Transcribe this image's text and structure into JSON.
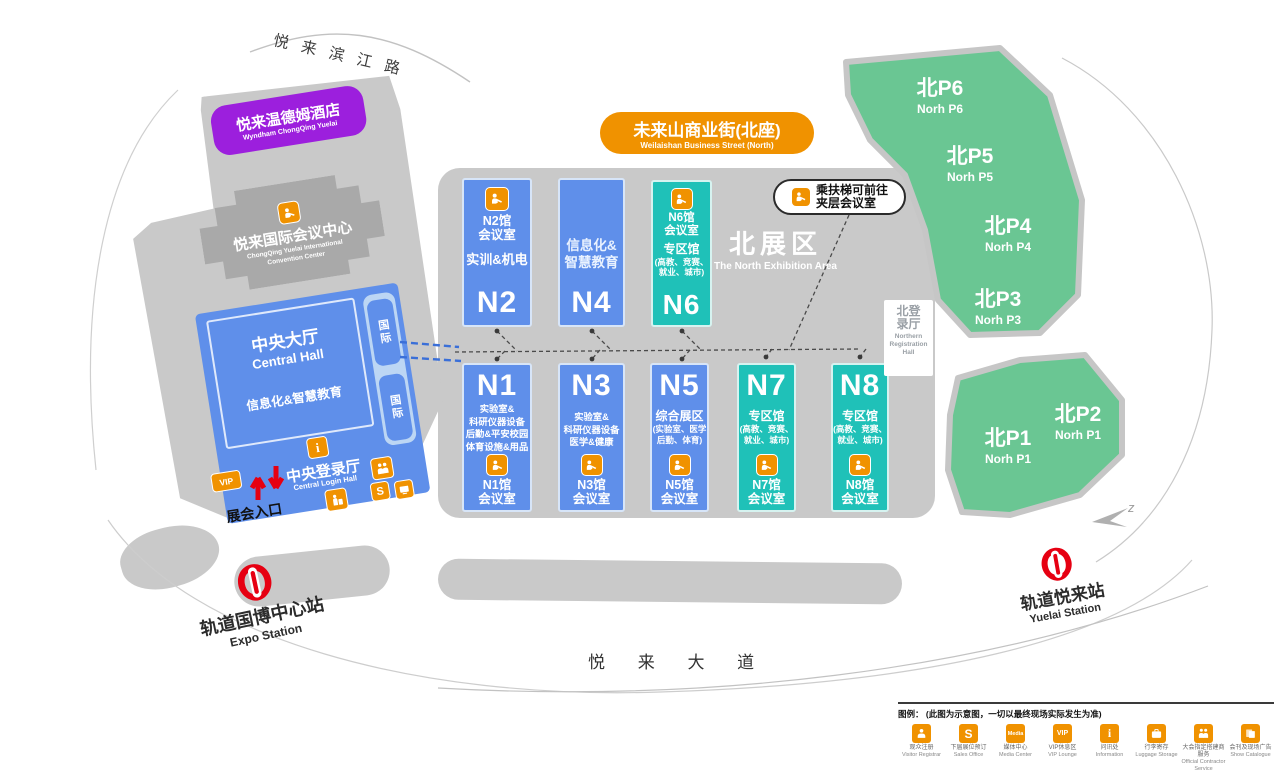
{
  "roads": {
    "top": "悦来滨江路",
    "bottom": "悦 来 大 道"
  },
  "hotel": {
    "cn": "悦来温德姆酒店",
    "en": "Wyndham ChongQing Yuelai"
  },
  "convention": {
    "cn": "悦来国际会议中心",
    "en": "ChongQing Yuelai International\nConvention Center"
  },
  "central_hall": {
    "cn": "中央大厅",
    "en": "Central Hall",
    "theme": "信息化&智慧教育",
    "intl": "国际"
  },
  "central_login": {
    "cn": "中央登录厅",
    "en": "Central Login Hall"
  },
  "entrance": "展会入口",
  "street": {
    "cn": "未来山商业街(北座)",
    "en": "Weilaishan Business Street (North)"
  },
  "escalator_note": "乘扶梯可前往\n夹层会议室",
  "north_area": {
    "cn": "北展区",
    "en": "The North Exhibition Area"
  },
  "north_reg": {
    "cn": "北登\n录厅",
    "en": "Northern\nRegistration\nHall"
  },
  "badges": {
    "vip": "VIP",
    "s": "S",
    "media": "Media",
    "i": "i"
  },
  "halls": [
    {
      "id": "N2",
      "meeting": "N2馆\n会议室",
      "theme": "实训&机电"
    },
    {
      "id": "N4",
      "theme": "信息化&\n智慧教育"
    },
    {
      "id": "N6",
      "meeting": "N6馆\n会议室",
      "theme": "专区馆",
      "sub": "(高教、竞赛、\n就业、城市)"
    },
    {
      "id": "N1",
      "meeting": "N1馆\n会议室",
      "theme": "实验室&\n科研仪器设备\n后勤&平安校园\n体育设施&用品"
    },
    {
      "id": "N3",
      "meeting": "N3馆\n会议室",
      "theme": "实验室&\n科研仪器设备\n医学&健康"
    },
    {
      "id": "N5",
      "meeting": "N5馆\n会议室",
      "theme": "综合展区",
      "sub": "(实验室、医学\n后勤、体育)"
    },
    {
      "id": "N7",
      "meeting": "N7馆\n会议室",
      "theme": "专区馆",
      "sub": "(高教、竞赛、\n就业、城市)"
    },
    {
      "id": "N8",
      "meeting": "N8馆\n会议室",
      "theme": "专区馆",
      "sub": "(高教、竞赛、\n就业、城市)"
    }
  ],
  "parking": [
    {
      "cn": "北P6",
      "en": "Norh P6"
    },
    {
      "cn": "北P5",
      "en": "Norh P5"
    },
    {
      "cn": "北P4",
      "en": "Norh P4"
    },
    {
      "cn": "北P3",
      "en": "Norh P3"
    },
    {
      "cn": "北P2",
      "en": "Norh P1"
    },
    {
      "cn": "北P1",
      "en": "Norh P1"
    }
  ],
  "stations": {
    "expo": {
      "cn": "轨道国博中心站",
      "en": "Expo Station"
    },
    "yuelai": {
      "cn": "轨道悦来站",
      "en": "Yuelai Station"
    }
  },
  "compass": "z",
  "legend": {
    "title": "图例：  (此图为示意图，一切以最终现场实际发生为准)",
    "items": [
      {
        "cn": "观众注册",
        "en": "Visitor Registrar"
      },
      {
        "cn": "下届展位预订",
        "en": "Sales Office"
      },
      {
        "cn": "媒体中心",
        "en": "Media Center"
      },
      {
        "cn": "VIP休息区",
        "en": "VIP Lounge"
      },
      {
        "cn": "问讯处",
        "en": "Information"
      },
      {
        "cn": "行李寄存",
        "en": "Luggage Storage"
      },
      {
        "cn": "大会指定搭建商服务",
        "en": "Official Contractor Service"
      },
      {
        "cn": "会刊及现场广告",
        "en": "Show Catalogue"
      }
    ]
  }
}
